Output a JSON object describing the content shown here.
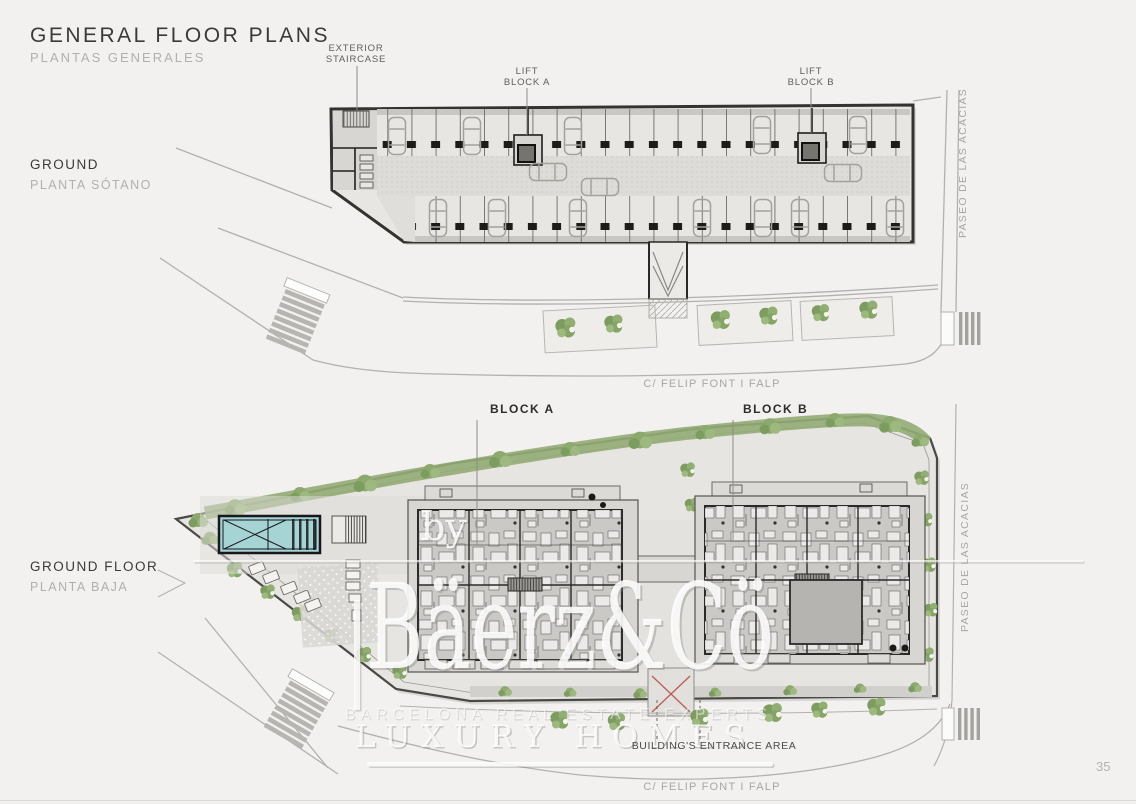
{
  "page": {
    "title": "GENERAL FLOOR PLANS",
    "subtitle": "PLANTAS GENERALES",
    "number": "35"
  },
  "basement": {
    "label": "GROUND",
    "sublabel": "PLANTA SÓTANO",
    "annotations": {
      "staircase_line1": "EXTERIOR",
      "staircase_line2": "STAIRCASE",
      "lift_a_line1": "LIFT",
      "lift_a_line2": "BLOCK A",
      "lift_b_line1": "LIFT",
      "lift_b_line2": "BLOCK B"
    }
  },
  "ground_floor": {
    "label": "GROUND FLOOR",
    "sublabel": "PLANTA BAJA",
    "annotations": {
      "block_a": "BLOCK A",
      "block_b": "BLOCK B",
      "entrance": "BUILDING'S ENTRANCE AREA"
    }
  },
  "streets": {
    "felip_top": "C/ FELIP FONT I FALP",
    "felip_bottom": "C/ FELIP FONT I FALP",
    "paseo_top": "PASEO DE LAS ACACIAS",
    "paseo_bottom": "PASEO DE LAS ACACIAS"
  },
  "watermark": {
    "by": "by",
    "brand": "Bäerz&Cö",
    "tagline": "BARCELONA REAL ESTATE EXPERTS",
    "tagline2": "LUXURY HOMES"
  },
  "colors": {
    "background": "#f2f1ef",
    "plan_fill": "#e8e6e2",
    "wall": "#2b2a28",
    "green": "#8caa6d",
    "pool_water": "#a6d4d4",
    "road_line": "#b3b1ae",
    "text_dark": "#3b3a38",
    "text_muted": "#b0aeab",
    "watermark": "#ffffff"
  }
}
